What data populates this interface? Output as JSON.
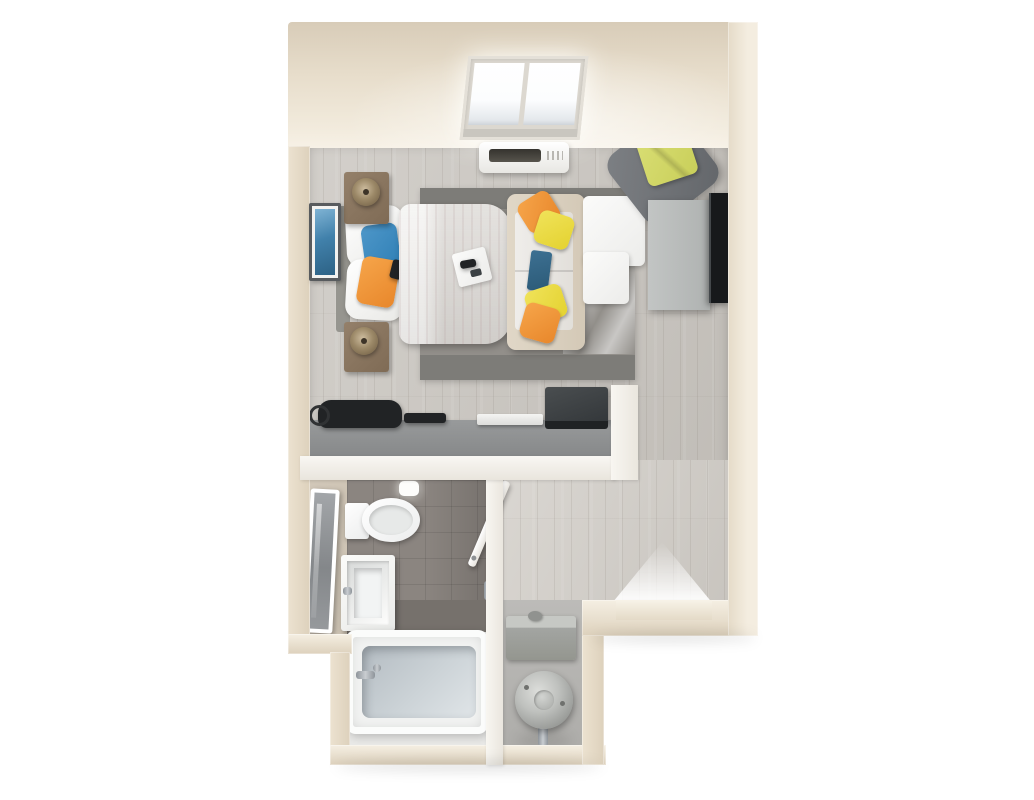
{
  "scene": {
    "kind": "3d-floor-plan-render",
    "unit": "studio-apartment",
    "background": "#ffffff"
  },
  "palette": {
    "wall": "#ece2d0",
    "wall_light": "#f5efe3",
    "wall_dark": "#ddd1bc",
    "floor": "#cbc7c1",
    "floor_light": "#d3cfc9",
    "bath_floor": "#8b8580",
    "bath_floor_dark": "#76716c",
    "bath_floor_light": "#d2c8b9",
    "rug": "#928f8a",
    "rug_dark": "#7d7c78",
    "counter": "#858788",
    "duvet": "#dcd9d5",
    "sofa_frame": "#d4c9b7",
    "seat_white": "#efedea",
    "pillow_blue": "#2f7fb5",
    "pillow_orange": "#e8872b",
    "pillow_yellow": "#e4d230",
    "pillow_chartreuse": "#c9cf5a",
    "tablet_navy": "#2b5a77",
    "wood_brown": "#7f6b55",
    "chair_gray": "#63666a",
    "cabinet": "#afb2b1",
    "tv_black": "#17191b",
    "tub_inner": "#ccd3d7",
    "appliance": "#a3a5a2",
    "art_blue": "#4181ab",
    "black_item": "#212325"
  },
  "rooms": {
    "main_room": {
      "fixtures": [
        "skylight",
        "ac-unit",
        "picture-frame",
        "nightstand-top",
        "nightstand-bottom",
        "table-lamp",
        "bed",
        "white-pillows",
        "blue-pillow",
        "orange-pillow",
        "bed-tray",
        "sofa",
        "chaise",
        "ottoman",
        "throw-pillows",
        "tablet",
        "lounge-chair",
        "chartreuse-pillow",
        "tv-stand",
        "tv",
        "area-rug",
        "desk-counter",
        "duffel-bag",
        "keyboard",
        "laptop"
      ]
    },
    "bathroom": {
      "fixtures": [
        "leaning-mirror",
        "toilet",
        "vanity-sink",
        "ceiling-light",
        "bathroom-door",
        "door-handle",
        "bathtub",
        "tub-faucet"
      ]
    },
    "hallway": {
      "fixtures": [
        "entry-threshold",
        "entry-light"
      ]
    },
    "utility_closet": {
      "fixtures": [
        "furnace-box",
        "water-heater",
        "water-pipe"
      ]
    }
  }
}
